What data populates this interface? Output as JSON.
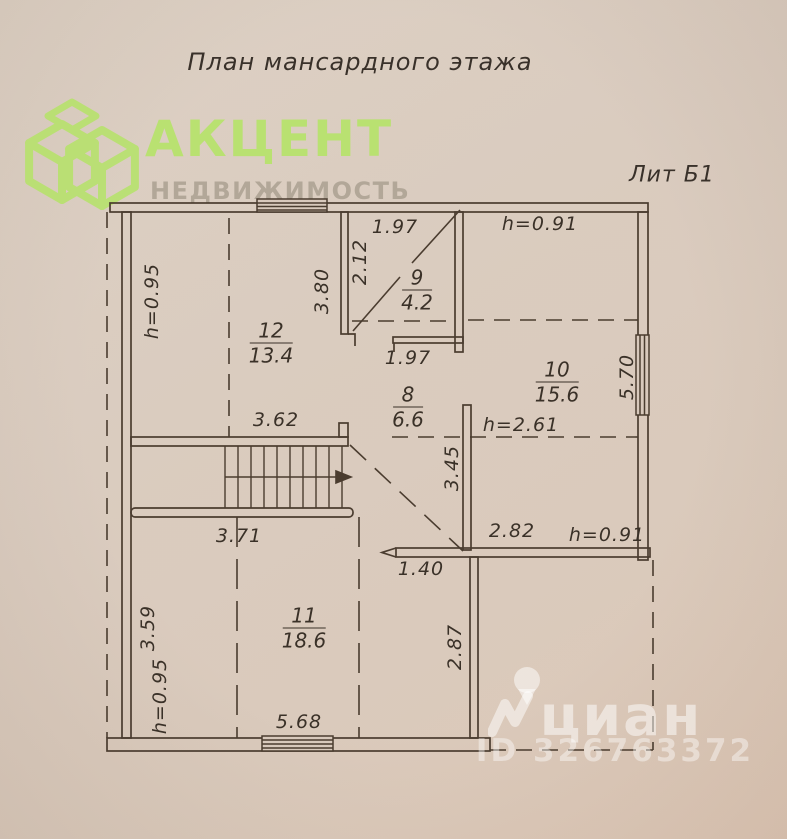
{
  "header": {
    "title": "План мансардного этажа",
    "lit": "Лит Б1"
  },
  "logo": {
    "brand": "АКЦЕНТ",
    "subtitle": "НЕДВИЖИМОСТЬ"
  },
  "watermark": {
    "name": "циан",
    "id": "ID 326763372"
  },
  "rooms": {
    "r12": {
      "num": "12",
      "area": "13.4"
    },
    "r9": {
      "num": "9",
      "area": "4.2"
    },
    "r10": {
      "num": "10",
      "area": "15.6"
    },
    "r8": {
      "num": "8",
      "area": "6.6"
    },
    "r11": {
      "num": "11",
      "area": "18.6"
    }
  },
  "dims": {
    "w197_top": "1.97",
    "h091_top": "h=0.91",
    "v212": "2.12",
    "v380": "3.80",
    "h095_top": "h=0.95",
    "w197_bot": "1.97",
    "v570": "5.70",
    "w362": "3.62",
    "h261": "h=2.61",
    "v345": "3.45",
    "w371": "3.71",
    "w282": "2.82",
    "h091_mid": "h=0.91",
    "w140": "1.40",
    "v287": "2.87",
    "v359": "3.59",
    "h095_bot": "h=0.95",
    "w568": "5.68"
  },
  "colors": {
    "paper": "#d8c9bc",
    "ink": "#4a3c2f",
    "label_ink": "#3a3128",
    "accent_green": "#b9e171",
    "logo_gray": "#a89e8f",
    "watermark_white": "rgba(255,255,255,0.5)"
  }
}
